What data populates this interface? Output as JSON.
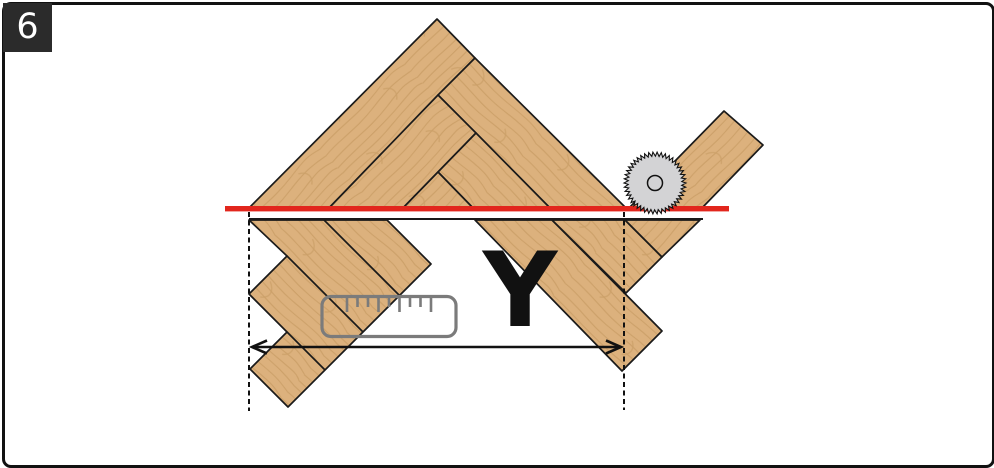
{
  "figure": {
    "number": "6",
    "dimension_label": "Y"
  },
  "icons": {
    "saw_blade": "saw-blade-icon",
    "ruler": "ruler-icon",
    "arrow": "double-headed-arrow"
  },
  "colors": {
    "wood": "#dcb17d",
    "wood_grain": "#bb9055",
    "outline": "#1a1a1a",
    "cut_line": "#e2261d",
    "ruler": "#7b7b7b",
    "saw_blade": "#d3d3d5",
    "badge_bg": "#2b2b2b",
    "badge_text": "#ffffff"
  }
}
